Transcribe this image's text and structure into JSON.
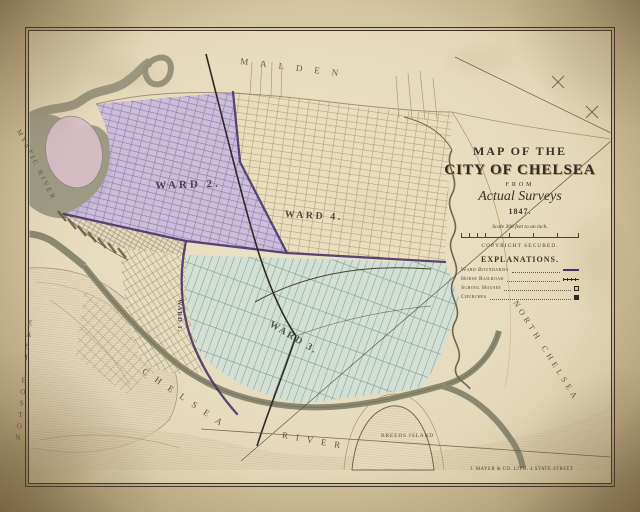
{
  "title_block": {
    "line1": "MAP OF THE",
    "line2": "CITY OF CHELSEA",
    "line3": "FROM",
    "line4": "Actual Surveys",
    "line5": "1847.",
    "scale_label": "Scale 300 feet to an inch.",
    "copyright": "COPYRIGHT SECURED.",
    "explanations_heading": "EXPLANATIONS.",
    "legend": [
      {
        "label": "Ward Boundaries"
      },
      {
        "label": "Horse Railroad"
      },
      {
        "label": "School Houses"
      },
      {
        "label": "Churches"
      }
    ]
  },
  "place_labels": {
    "malden": "MALDEN",
    "mystic_river": "MYSTIC RIVER",
    "east_boston": "EAST BOSTON",
    "north_chelsea": "NORTH CHELSEA",
    "chelsea_river_part1": "CHELSEA",
    "chelsea_river_part2": "RIVER",
    "breeds_island": "BREEDS ISLAND"
  },
  "ward_labels": {
    "ward1": "WARD 1.",
    "ward2": "WARD 2.",
    "ward3": "WARD 3.",
    "ward4": "WARD 4."
  },
  "credit_line": "J. MAYER & CO. LITH. 4 STATE STREET",
  "colors": {
    "paper": "#d9cda9",
    "ward2_tint": "#c9badb",
    "ward3_tint": "#d2e0d8",
    "ward4_tint": "#e8ddbb",
    "water": "#9d9a82",
    "boundary_purple": "#453069",
    "frame_ink": "#2b2118"
  }
}
